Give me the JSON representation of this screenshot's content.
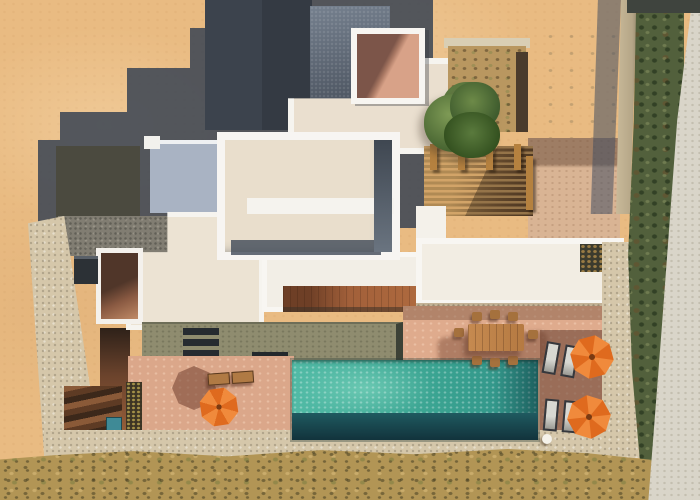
{
  "scene": {
    "type": "aerial-photograph",
    "subject": "Top-down drone view of a modern white flat-roof villa with a long rectangular pool, terracotta sun terraces and landscaped sandy grounds",
    "lighting": "strong sunlight casting long stepped shadows toward the upper left"
  },
  "palette": {
    "sand": "#e9bb82",
    "cast_shadow": "#4d5663",
    "roof_white": "#f6f4ef",
    "roof_cream": "#e9decc",
    "roof_dark": "#343a43",
    "concrete_grey": "#5d6878",
    "roof_bluegrey": "#a9b3c3",
    "courtyard_floor": "#d7a086",
    "stone_paving": "#d5c7aa",
    "terrace_terracotta": "#dba88b",
    "deck_olive": "#8f8c6f",
    "pool_water": "#3fae9a",
    "pool_deep": "#1a4c52",
    "walkway_wood": "#a2603a",
    "pergola_wood": "#c89355",
    "umbrella_orange": "#ed7a2e",
    "tree_green": "#55733a",
    "hedge_green": "#52603c",
    "scrub": "#b29555",
    "pale_path": "#d9d5c9"
  },
  "elements": {
    "villa": {
      "label": "white villa with stacked flat roofs",
      "features": [
        "stepped parapet roofs",
        "roof courtyard opening (top)",
        "roof courtyard opening (left)",
        "blue-grey lower roof",
        "dark shaded roof section"
      ]
    },
    "pool": {
      "label": "long rectangular swimming pool",
      "water_color": "#3fae9a"
    },
    "sun_deck": {
      "label": "olive-green deck above pool with three dark steps"
    },
    "terraces": {
      "label": "terracotta terraces around pool"
    },
    "umbrellas": {
      "label": "orange octagonal parasols",
      "count": 3,
      "color": "#ed7a2e"
    },
    "dining_set": {
      "label": "wooden outdoor dining table with chairs"
    },
    "loungers": {
      "label": "sun loungers beside parasols"
    },
    "pergola": {
      "label": "wooden slatted pergola"
    },
    "tree": {
      "label": "green tree beside pergola"
    },
    "planter": {
      "label": "rooftop planter bed with shrubs"
    },
    "boundary_wall": {
      "label": "stone boundary wall casting shadow"
    },
    "hedge": {
      "label": "green hedge strip along right boundary"
    },
    "ground": {
      "label": "sandy plot with dry scrub strip at bottom"
    },
    "stairs": {
      "label": "dark terracotta stairs at lower left"
    }
  }
}
